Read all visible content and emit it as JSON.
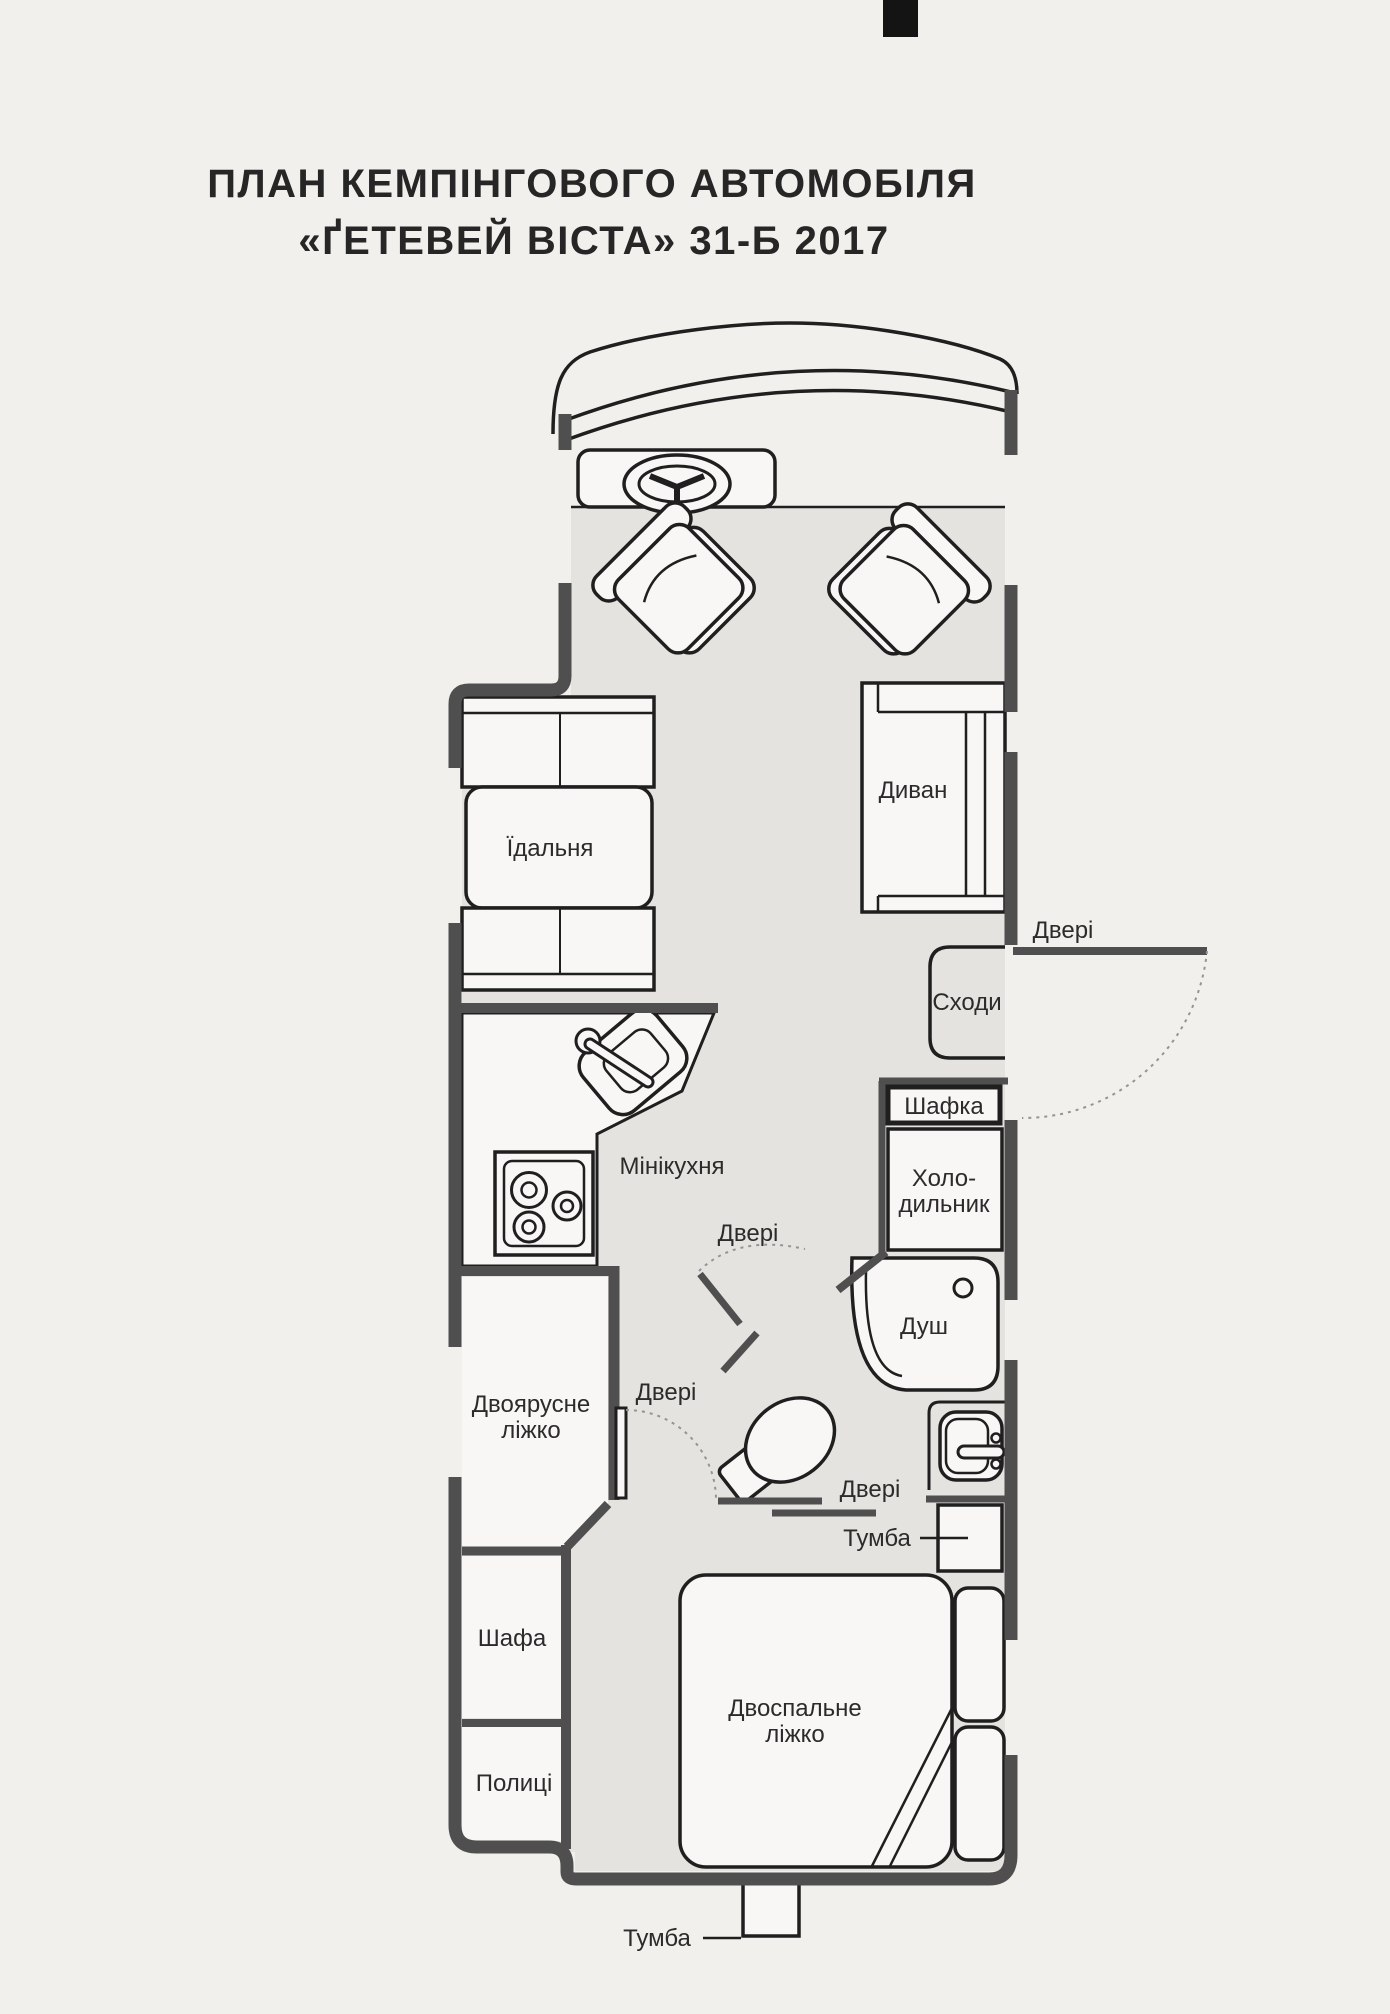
{
  "title": {
    "line1": "ПЛАН КЕМПІНГОВОГО АВТОМОБІЛЯ",
    "line2": "«ҐЕТЕВЕЙ ВІСТА» 31-Б 2017"
  },
  "plan": {
    "labels": {
      "dining": "Їдальня",
      "sofa": "Диван",
      "door_entry": "Двері",
      "stairs": "Сходи",
      "cabinet": "Шафка",
      "fridge_line1": "Холо-",
      "fridge_line2": "дильник",
      "mini_kitchen": "Мінікухня",
      "door_bathroom": "Двері",
      "shower": "Душ",
      "bunk_line1": "Двоярусне",
      "bunk_line2": "ліжко",
      "door_corridor": "Двері",
      "door_bedroom": "Двері",
      "nightstand_mid": "Тумба",
      "bed_line1": "Двоспальне",
      "bed_line2": "ліжко",
      "wardrobe": "Шафа",
      "shelves": "Полиці",
      "nightstand_rear": "Тумба"
    },
    "colors": {
      "page_background": "#f2f0ed",
      "wall": "#4f4f4f",
      "interior": "#e4e3e0",
      "furniture": "#f8f7f5",
      "outline": "#1f1f1f",
      "door_arc": "#949494"
    }
  }
}
